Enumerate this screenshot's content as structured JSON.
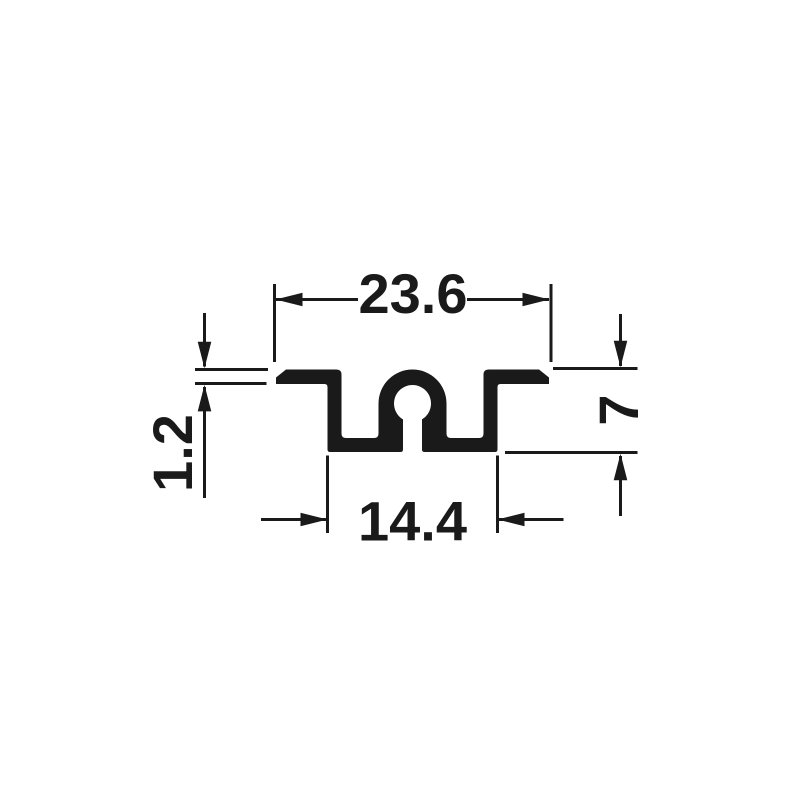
{
  "colors": {
    "ink": "#1a1a1a",
    "background": "#ffffff"
  },
  "dimensions": {
    "top_width": "23.6",
    "bottom_width": "14.4",
    "height": "7",
    "flange_thickness": "1.2"
  }
}
